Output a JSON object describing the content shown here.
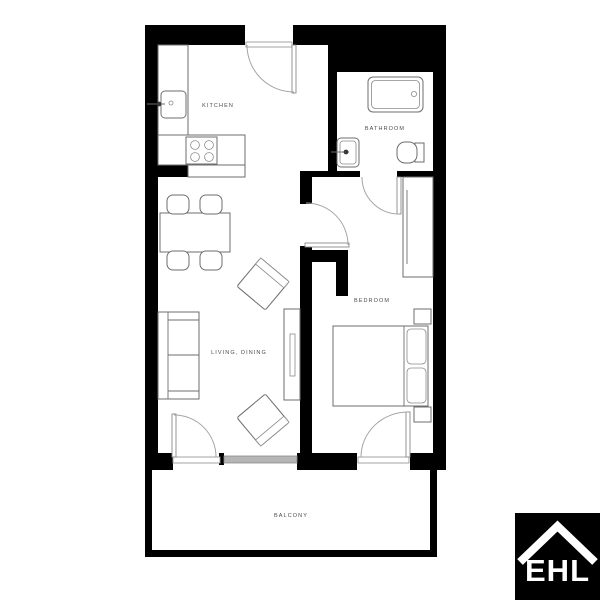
{
  "floorplan": {
    "rooms": [
      {
        "id": "kitchen",
        "label": "KITCHEN"
      },
      {
        "id": "bathroom",
        "label": "BATHROOM"
      },
      {
        "id": "bedroom",
        "label": "BEDROOM"
      },
      {
        "id": "living_dining",
        "label": "LIVING, DINING"
      },
      {
        "id": "balcony",
        "label": "BALCONY"
      }
    ],
    "colors": {
      "wall": "#000000",
      "furniture_outline": "#6e6e6e",
      "door_arc": "#a5a5a5",
      "label_text": "#4a4a4a",
      "window": "#b5b5b5"
    }
  },
  "logo": {
    "text": "EHL",
    "bg": "#000000",
    "fg": "#ffffff"
  }
}
